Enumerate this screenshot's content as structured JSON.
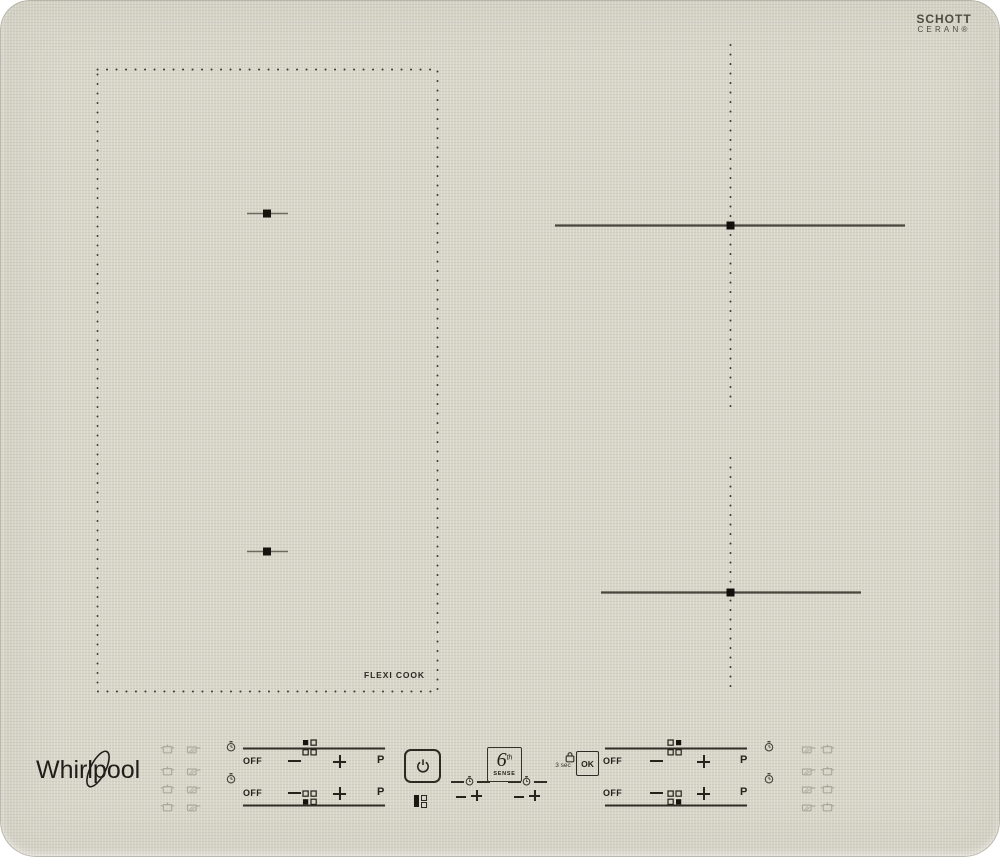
{
  "branding": {
    "whirlpool_logo": "Whirlpool",
    "glass_maker_line1": "SCHOTT",
    "glass_maker_line2": "CERAN®"
  },
  "surface": {
    "flexi_zone_label": "FLEXI COOK",
    "zones": {
      "left": "flexicook-dual-zone-dotted",
      "top_right": "crosshair-zone",
      "bottom_right": "crosshair-zone"
    }
  },
  "control_panel": {
    "zone_sliders": {
      "off_label": "OFF",
      "boost_label": "P"
    },
    "six_sense_badge": {
      "digit": "6",
      "superscript": "th",
      "word": "SENSE"
    },
    "lock": {
      "hint": "3 sec"
    },
    "ok_button_label": "OK"
  },
  "icons": {
    "power": "power-icon",
    "timer_clock": "stopwatch-icon",
    "lock": "padlock-icon",
    "cookware_left_columns": [
      "pot",
      "pan"
    ],
    "cookware_right_columns": [
      "pan",
      "pot"
    ],
    "minus": "−",
    "plus": "+"
  },
  "colors": {
    "surface": "#d8d6c9",
    "background": "#ffffff",
    "ink": "#24231c",
    "zone_line": "#47453c",
    "faint_icon": "#a8a496"
  }
}
